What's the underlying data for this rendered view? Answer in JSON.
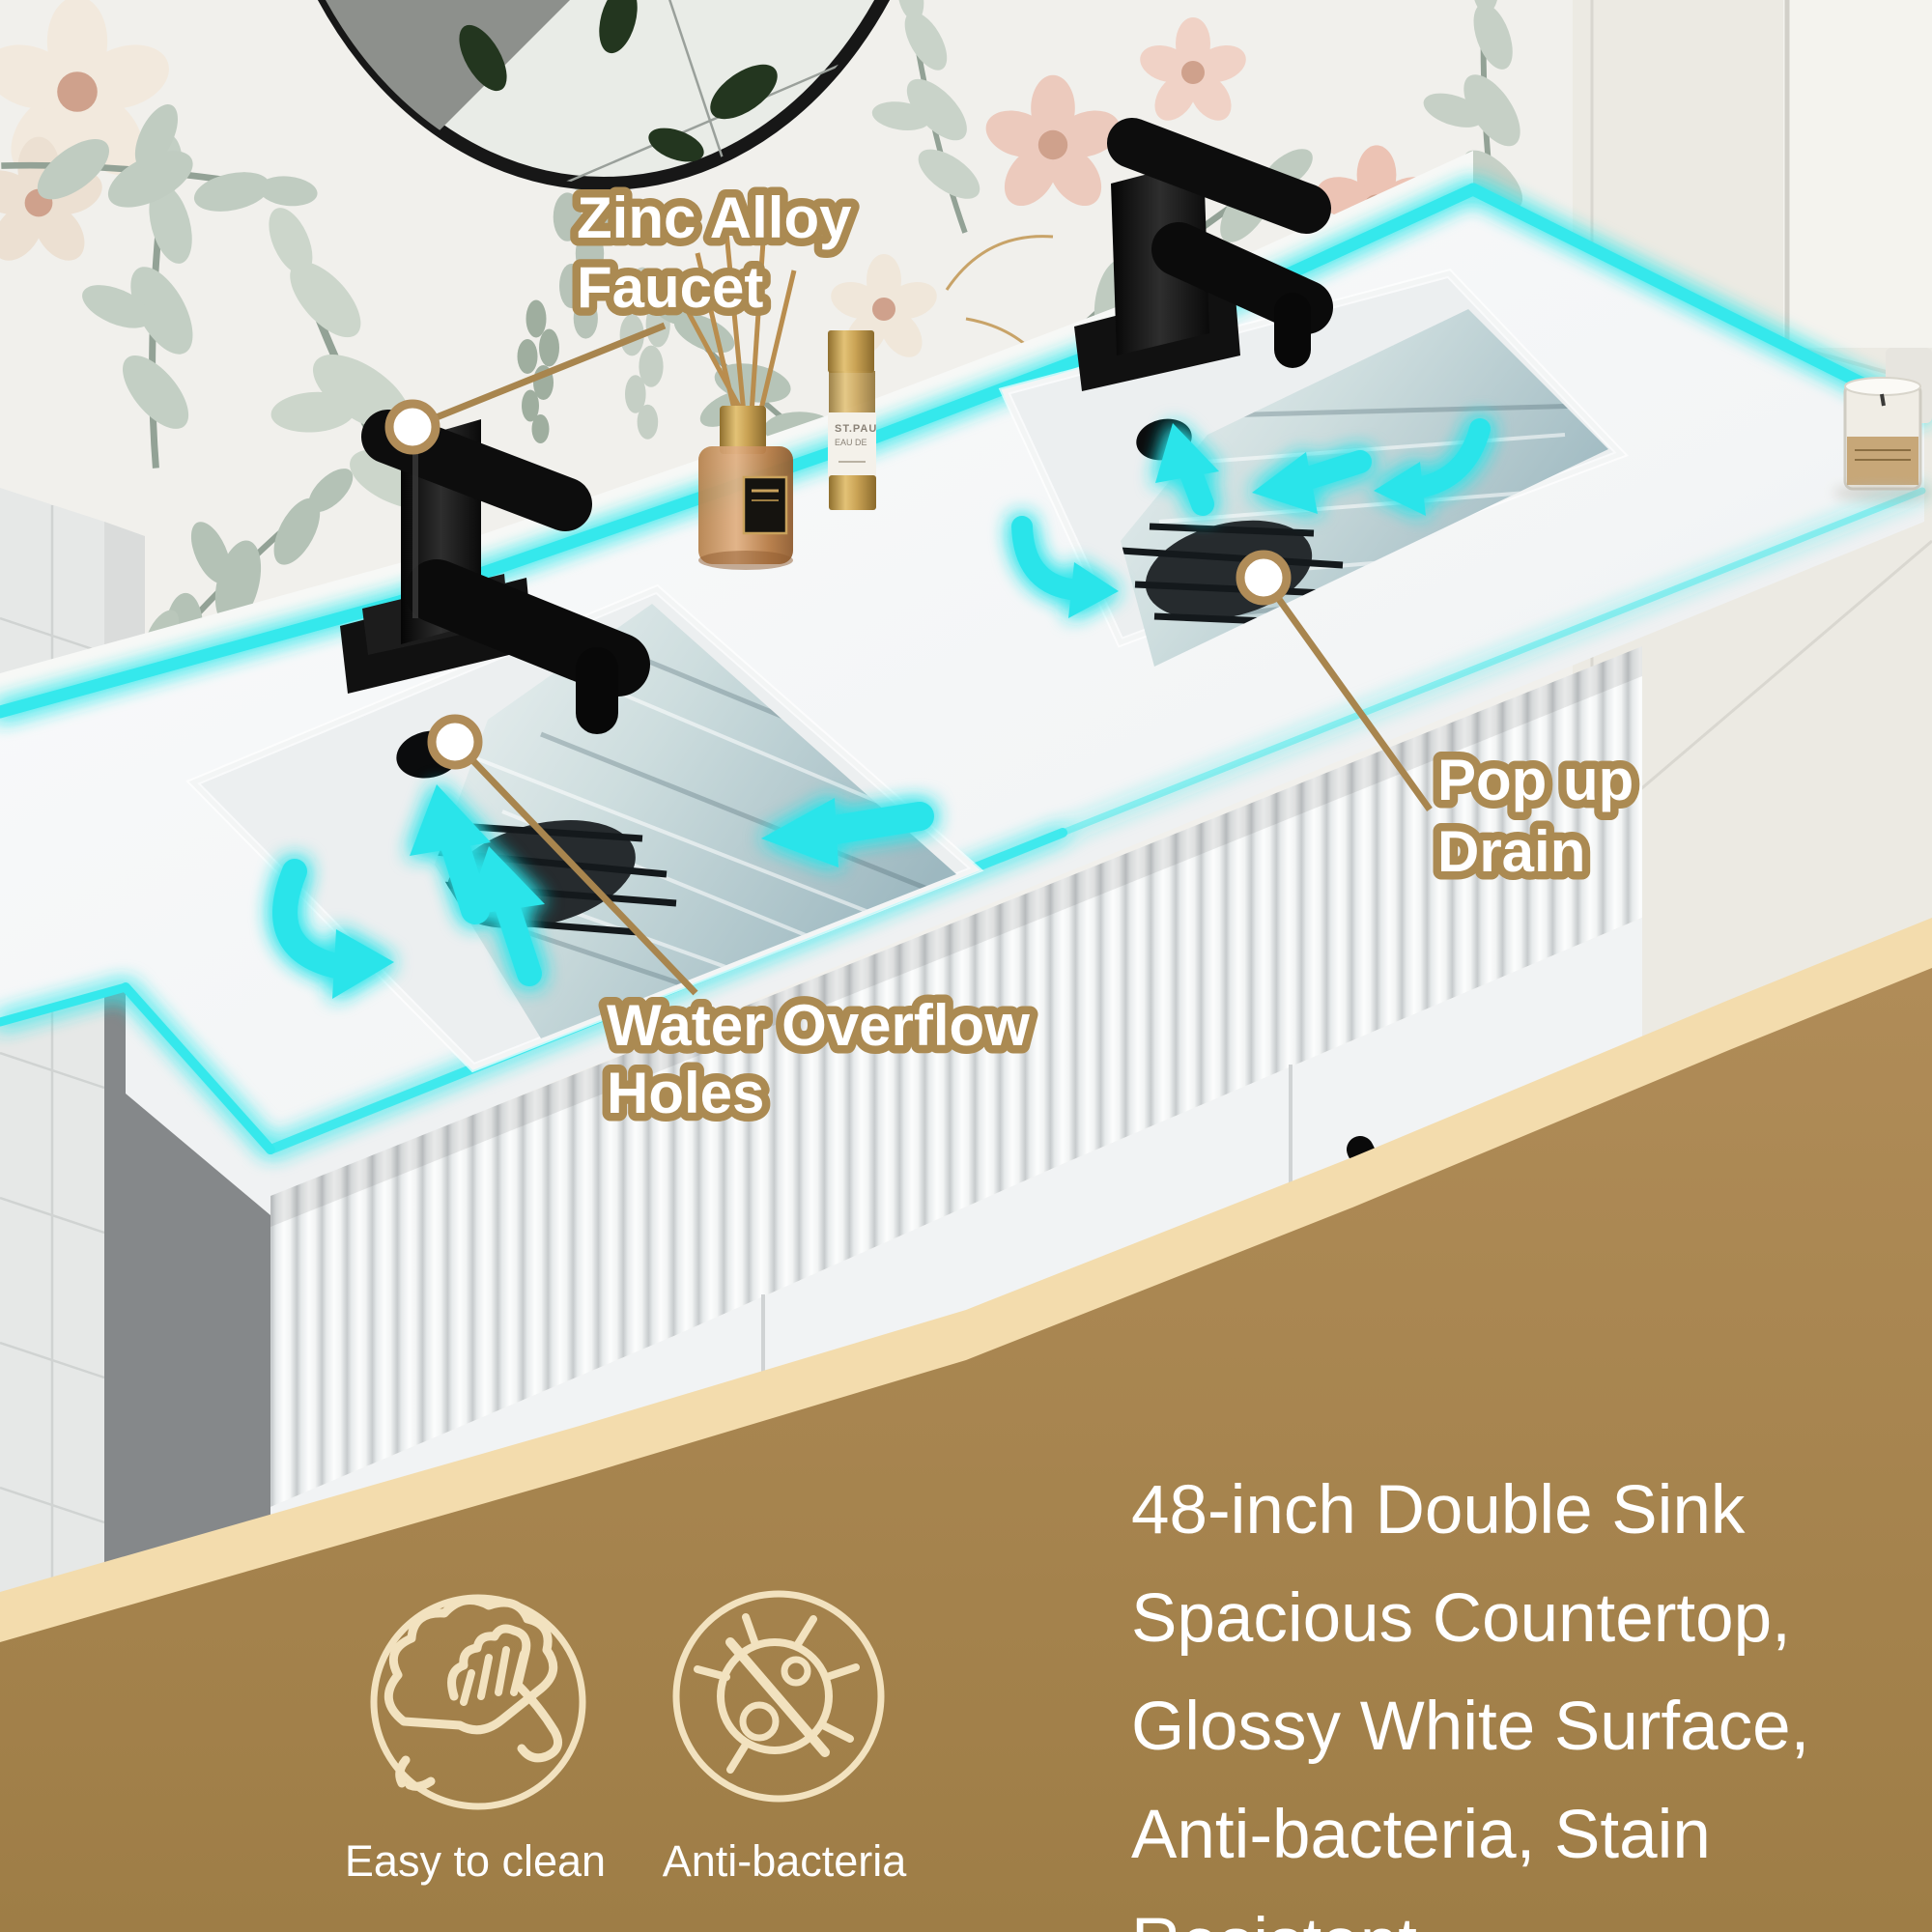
{
  "scene": {
    "subject": "48-inch white double-sink bathroom vanity product photo",
    "style": "marketing annotation render"
  },
  "callouts": {
    "faucet": {
      "line1": "Zinc Alloy",
      "line2": "Faucet"
    },
    "overflow": {
      "line1": "Water Overflow",
      "line2": "Holes"
    },
    "drain": {
      "line1": "Pop up",
      "line2": "Drain"
    }
  },
  "features": [
    {
      "icon": "wipe-clean-icon",
      "label": "Easy to clean"
    },
    {
      "icon": "anti-bacteria-icon",
      "label": "Anti-bacteria"
    }
  ],
  "description": "48-inch Double Sink Spacious Countertop, Glossy White Surface, Anti-bacteria, Stain Resistant",
  "decor": {
    "perfume_bottle_label_line1": "ST.PAU",
    "perfume_bottle_label_line2": "EAU DE"
  },
  "colors": {
    "accent_cyan": "#36E8EC",
    "callout_outline_tan": "#AB8A52",
    "overlay_brown": "#A8854E",
    "overlay_stripe_cream": "#F3DCAD",
    "icon_cream": "#F2E2BF",
    "text_white": "#FFFFFF"
  }
}
